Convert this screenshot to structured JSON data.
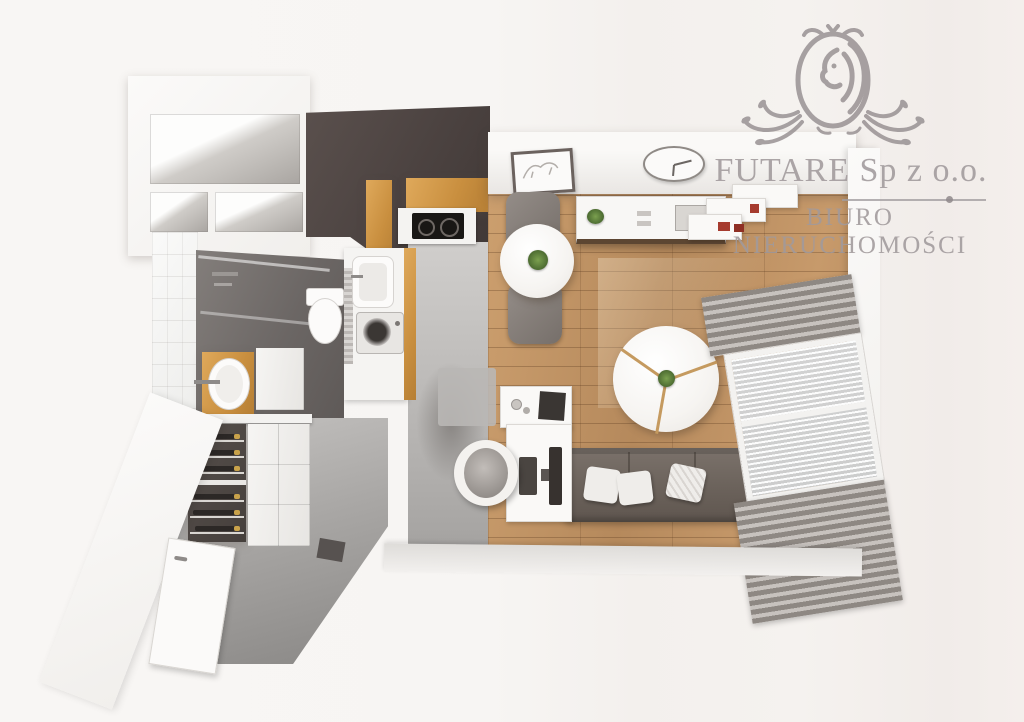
{
  "watermark": {
    "logo_icon": "lion-crest-icon",
    "company": "FUTARE Sp z o.o.",
    "subtitle": "BIURO NIERUCHOMOŚCI",
    "text_color": "#a19a9c"
  },
  "scene": {
    "type": "3d-floor-plan-top-down-render",
    "rooms": [
      {
        "name": "wardrobe-closet"
      },
      {
        "name": "kitchen"
      },
      {
        "name": "bathroom"
      },
      {
        "name": "hallway-entry"
      },
      {
        "name": "living-room"
      }
    ],
    "furniture": [
      "wardrobe shelf niches",
      "kitchen wood cabinets",
      "cooktop",
      "kitchen sink",
      "washing machine",
      "shower",
      "toilet",
      "vanity sink",
      "wine rack with bottles",
      "hallway cabinets",
      "entry door",
      "doormat",
      "picture frame",
      "wall clock",
      "sideboard with plant",
      "wall shelf unit",
      "dining table with plant",
      "dining chairs",
      "round segmented coffee table",
      "sofa with pillows",
      "desk with monitor",
      "side table with laptop",
      "armchair",
      "rug",
      "striped curtains",
      "window"
    ],
    "palette": {
      "background": "#f7f5f3",
      "wall_white": "#fafaf9",
      "dark_wall": "#4b4240",
      "wood_floor": "#bf9065",
      "oak_cabinet": "#cf9a4b",
      "concrete_floor": "#a5a3a1",
      "bathroom_floor": "#6b6664",
      "sofa": "#6b625b",
      "curtain": "#8e8883",
      "accent_red": "#a63b2e",
      "plant_green": "#4c6b31"
    }
  }
}
